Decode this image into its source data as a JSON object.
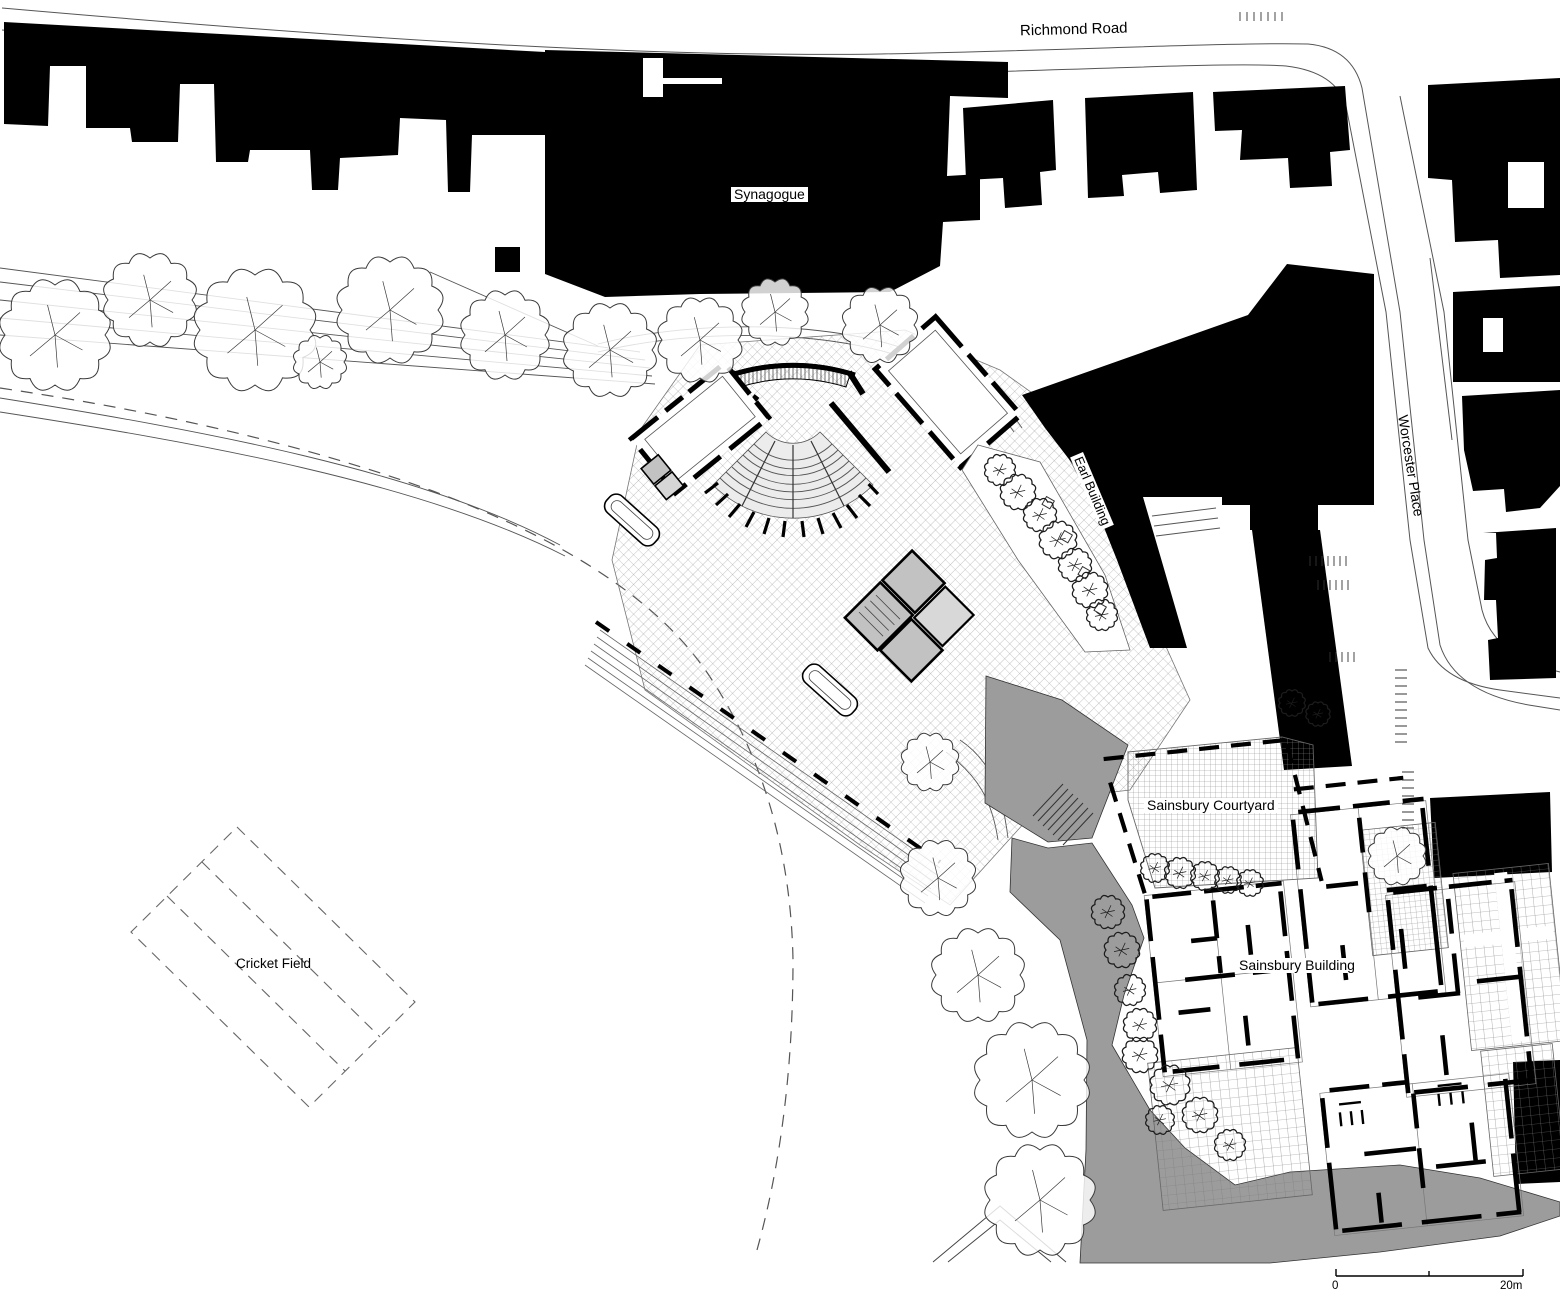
{
  "labels": {
    "richmond_road": "Richmond Road",
    "synagogue": "Synagogue",
    "earl_building": "Earl Building",
    "worcester_place": "Worcester Place",
    "sainsbury_courtyard": "Sainsbury Courtyard",
    "cricket_field": "Cricket Field",
    "sainsbury_building": "Sainsbury Building"
  },
  "scale_bar": {
    "zero_label": "0",
    "end_label": "20m"
  },
  "colors": {
    "ink": "#000000",
    "landscape_gray": "#9c9c9c",
    "room_gray": "#c2c2c2",
    "paper": "#ffffff"
  }
}
